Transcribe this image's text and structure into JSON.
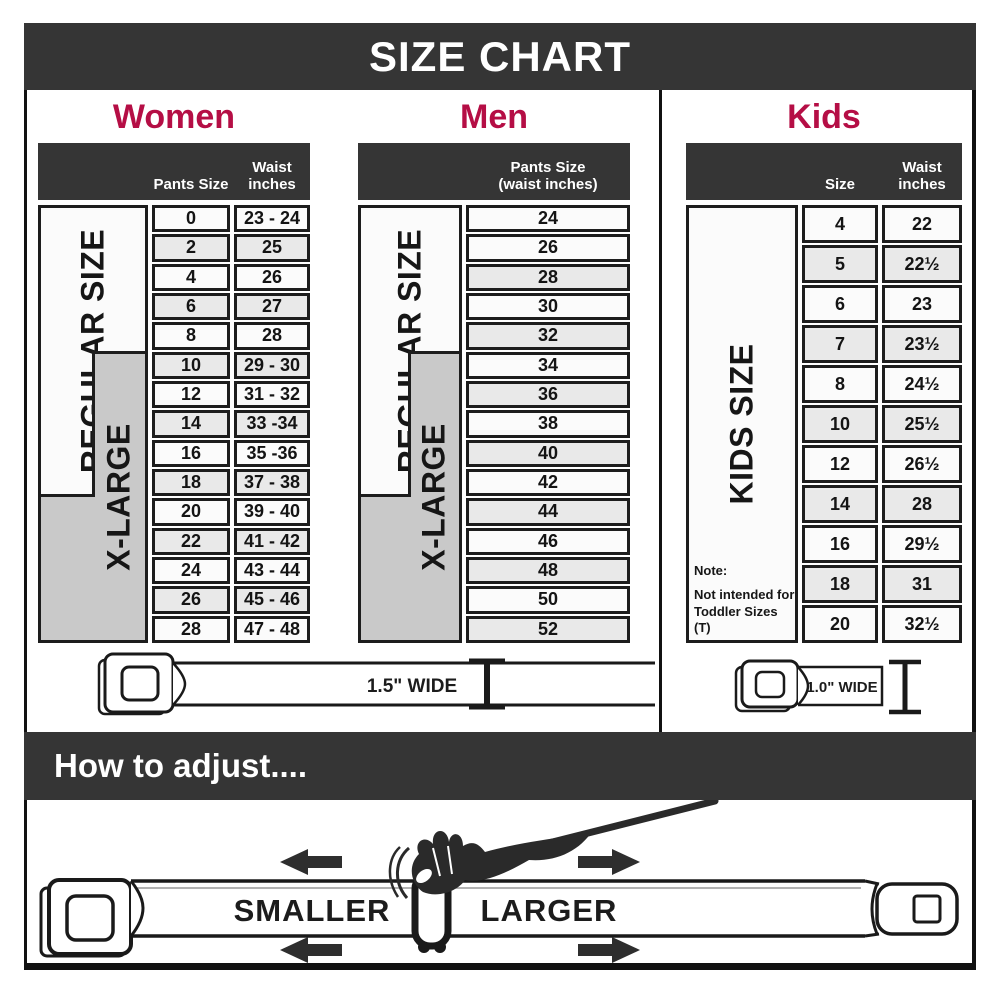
{
  "title": "SIZE CHART",
  "colors": {
    "accent_red": "#b50e45",
    "header_dark": "#353535",
    "row_alt_gray": "#e9e9e9",
    "label_gray": "#c9c9c9"
  },
  "sections": {
    "women": {
      "heading": "Women",
      "col1_header": "Pants Size",
      "col2_header_line1": "Waist",
      "col2_header_line2": "inches",
      "regular_label": "REGULAR SIZE",
      "xlarge_label": "X-LARGE",
      "rows": [
        {
          "size": "0",
          "waist": "23 - 24"
        },
        {
          "size": "2",
          "waist": "25"
        },
        {
          "size": "4",
          "waist": "26"
        },
        {
          "size": "6",
          "waist": "27"
        },
        {
          "size": "8",
          "waist": "28"
        },
        {
          "size": "10",
          "waist": "29 - 30"
        },
        {
          "size": "12",
          "waist": "31 - 32"
        },
        {
          "size": "14",
          "waist": "33 -34"
        },
        {
          "size": "16",
          "waist": "35 -36"
        },
        {
          "size": "18",
          "waist": "37 - 38"
        },
        {
          "size": "20",
          "waist": "39 - 40"
        },
        {
          "size": "22",
          "waist": "41 - 42"
        },
        {
          "size": "24",
          "waist": "43 - 44"
        },
        {
          "size": "26",
          "waist": "45 - 46"
        },
        {
          "size": "28",
          "waist": "47 - 48"
        }
      ],
      "belt_label": "1.5\" WIDE"
    },
    "men": {
      "heading": "Men",
      "col_header_line1": "Pants Size",
      "col_header_line2": "(waist inches)",
      "regular_label": "REGULAR SIZE",
      "xlarge_label": "X-LARGE",
      "rows": [
        "24",
        "26",
        "28",
        "30",
        "32",
        "34",
        "36",
        "38",
        "40",
        "42",
        "44",
        "46",
        "48",
        "50",
        "52"
      ]
    },
    "kids": {
      "heading": "Kids",
      "col1_header": "Size",
      "col2_header_line1": "Waist",
      "col2_header_line2": "inches",
      "side_label": "KIDS SIZE",
      "note_line1": "Note:",
      "note_line2": "Not intended for",
      "note_line3": "Toddler Sizes (T)",
      "rows": [
        {
          "size": "4",
          "waist": "22"
        },
        {
          "size": "5",
          "waist": "22½"
        },
        {
          "size": "6",
          "waist": "23"
        },
        {
          "size": "7",
          "waist": "23½"
        },
        {
          "size": "8",
          "waist": "24½"
        },
        {
          "size": "10",
          "waist": "25½"
        },
        {
          "size": "12",
          "waist": "26½"
        },
        {
          "size": "14",
          "waist": "28"
        },
        {
          "size": "16",
          "waist": "29½"
        },
        {
          "size": "18",
          "waist": "31"
        },
        {
          "size": "20",
          "waist": "32½"
        }
      ],
      "belt_label": "1.0\" WIDE"
    }
  },
  "adjust": {
    "heading": "How to adjust....",
    "smaller_label": "SMALLER",
    "larger_label": "LARGER"
  }
}
